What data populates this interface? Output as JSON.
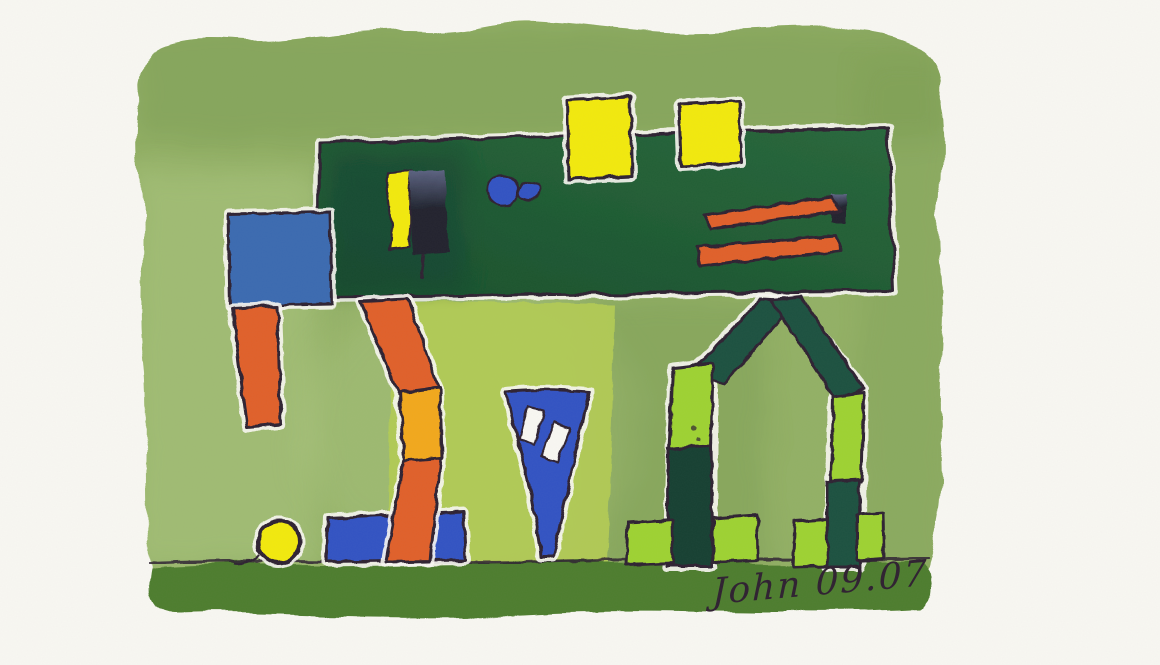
{
  "artwork": {
    "kind": "watercolor painting",
    "description": "Abstract watercolor of block figures on a green wash: a dark green panel with yellow squares and orange stripes, a blue-headed figure with orange legs, a blue wedge, a block archway, and a yellow ball on a dark green ground strip",
    "signature": "John 09.07"
  },
  "palette": {
    "paper": "#f2f1ea",
    "paper_halo": "#f8f7f2",
    "wash_green": "#92b065",
    "wash_light": "#b2ca85",
    "wash_dark": "#76984e",
    "ground_green": "#4e7d2d",
    "chartreuse": "#b2cb55",
    "lime": "#9ed231",
    "arch_green": "#1c5140",
    "arch_green_deep": "#143f33",
    "billboard_a": "#27673b",
    "billboard_b": "#174f2b",
    "yellow": "#f2e90f",
    "yellow_orange": "#f2a81e",
    "orange": "#e0612a",
    "blue_square": "#3a6bb0",
    "blue_royal": "#3353c3",
    "navy_a": "#5c6382",
    "navy_b": "#20242f",
    "ink": "#2e2030"
  }
}
